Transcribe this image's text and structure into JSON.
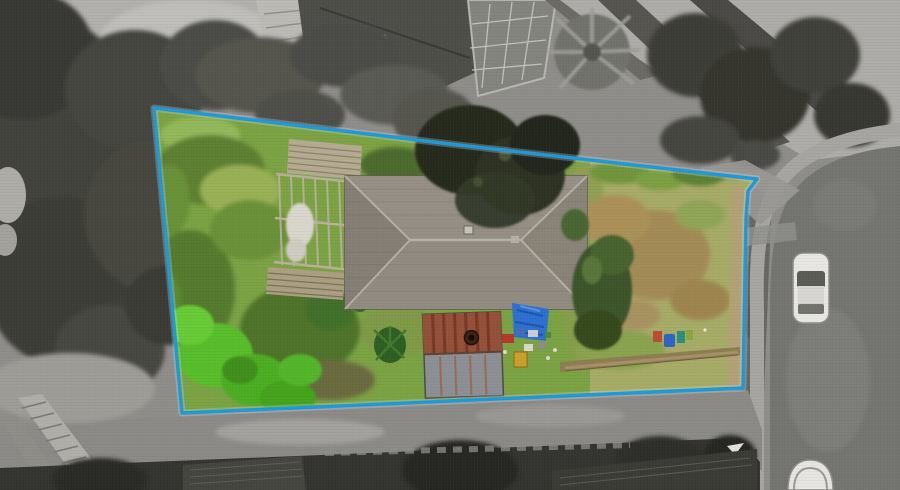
{
  "image": {
    "kind": "aerial-drone-photograph",
    "style": "top-down real-estate photo; property lot rendered in colour, surroundings desaturated greyscale"
  },
  "boundary": {
    "points": "154,108 450,144 757,179 748,191 746,218 743,388 182,413",
    "stroke_width": "3.5"
  },
  "colors": {
    "background_gray": "#8f8d89",
    "boundary_blue": "#1f9ad8",
    "garden_green": "#7ba243",
    "lawn_green": "#a6ab66",
    "roof_gray": "#8e897f",
    "dark_tree": "#262a1c",
    "shed_rust": "#95503a",
    "shed_metal": "#8c9094",
    "tarp_blue": "#2e6fd2",
    "concrete_gray": "#aeaca8",
    "road_gray": "#747470",
    "footpath_gray": "#a7a5a1",
    "car_white": "#e8e7e3",
    "hedge_dark": "#343430",
    "lime_tree": "#58bd2c",
    "bin_red": "#bf4a33",
    "bin_blue": "#2f64c4",
    "bin_teal": "#27917b",
    "crate_yellow": "#c9a02b"
  },
  "objects": {
    "lot": [
      "overgrown-garden",
      "house-roof",
      "pergola-frame",
      "timber-deck",
      "rusty-shed",
      "blue-tarp",
      "junk-pile",
      "yellow-crate",
      "wheelie-bins",
      "back-lawn",
      "dark-tree",
      "palm-shrub",
      "dirt-path"
    ],
    "surroundings": [
      "neighbour-house",
      "conservatory-roof",
      "garden-shed",
      "driveway-fan",
      "street-road",
      "footpath",
      "parked-car",
      "partial-car",
      "street-trees",
      "hedge-row",
      "timber-boardwalk",
      "bottom-road"
    ]
  }
}
